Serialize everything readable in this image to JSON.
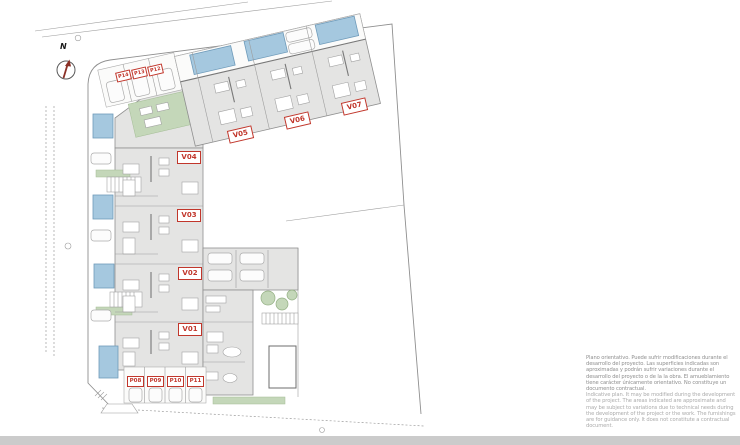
{
  "colors": {
    "red": "#C1362B",
    "pool": "#A5C8DF",
    "green": "#C4D7B9",
    "building": "#E4E4E3",
    "bar": "#CBCBCB"
  },
  "compass": {
    "north_label": "N"
  },
  "units": {
    "v01": "V01",
    "v02": "V02",
    "v03": "V03",
    "v04": "V04",
    "v05": "V05",
    "v06": "V06",
    "v07": "V07"
  },
  "parking": {
    "p08": "P08",
    "p09": "P09",
    "p10": "P10",
    "p11": "P11",
    "p12": "P12",
    "p13": "P13",
    "p14": "P14"
  },
  "disclaimer": {
    "es": "Plano orientativo. Puede sufrir modificaciones durante el desarrollo del proyecto. Las superficies indicadas son aproximadas y podrán sufrir variaciones durante el desarrollo del proyecto o de la la obra. El amueblamiento tiene carácter únicamente orientativo. No constituye un documento contractual.",
    "en": "Indicative plan. It may be modified during the development of the project. The areas indicated are approximate and may be subject to variations due to technical needs during the development of the project or the work. The furnishings are for guidance only. It does not constitute a contractual document."
  }
}
